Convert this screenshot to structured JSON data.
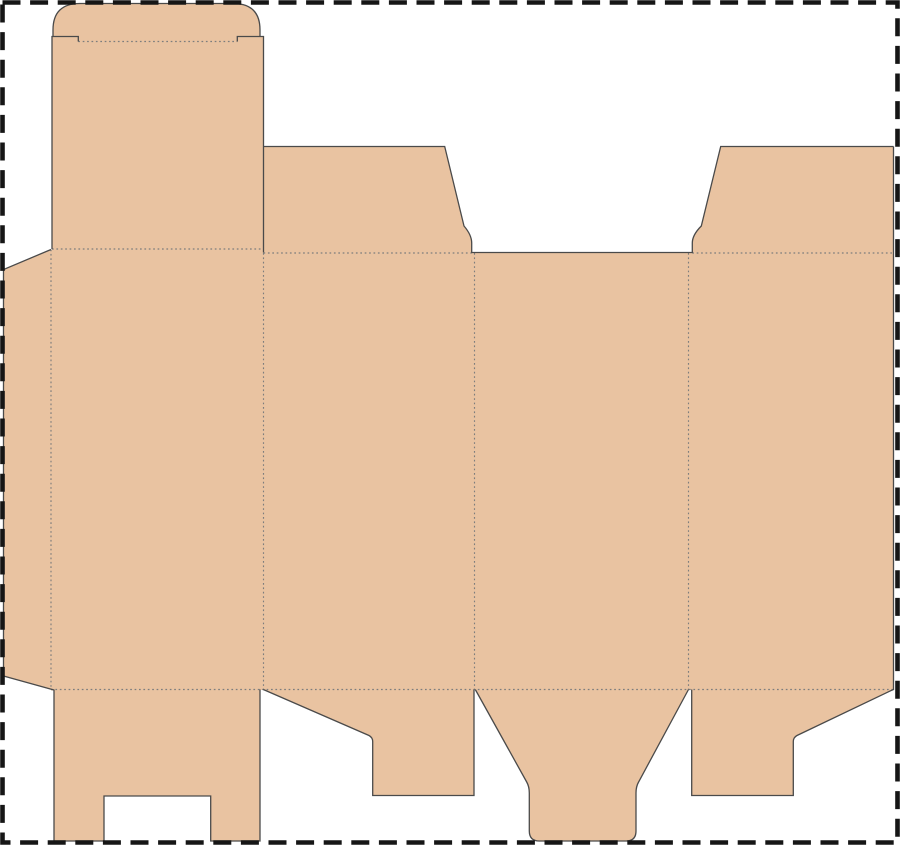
{
  "app": {
    "type": "packaging-dieline-diagram",
    "title": ""
  },
  "canvas": {
    "width": 900,
    "height": 845,
    "background": "#ffffff",
    "border": {
      "color": "#161616",
      "width": 4.6,
      "dash": "18 9.6",
      "inset": 2.5
    }
  },
  "dieline": {
    "material_color": "#e9c3a1",
    "cut_color": "#4a4a4a",
    "cut_width": 1.3,
    "fold_color": "#7d7d7d",
    "fold_width": 1.15,
    "fold_dash": "1.7 2.7",
    "fills": [
      {
        "name": "tuck-flap-fill",
        "path": "M 53,38 L 53,30 Q 53,3.5 80,3.5 L 233,3.5 Q 260,3.5 260,30 L 260,38 Z"
      },
      {
        "name": "lid-panel-fill",
        "path": "M 52,36.5 L 263.5,36.5 L 263.5,253 L 52,253 Z"
      },
      {
        "name": "glue-flap-fill",
        "path": "M 51,249.5 L 3.5,269.5 L 3.5,676 L 54,690.5 L 51,690.5 Z"
      },
      {
        "name": "body-panels-fill",
        "path": "M 51,249.5 L 263.5,249.5 L 263.5,253 L 893.5,253 L 893.5,690 L 51,690 Z"
      },
      {
        "name": "top-flap-2-fill",
        "path": "M 263.5,253 L 263.5,146.5 L 444.7,146.5 L 464,226 Q 471.7,235 471.7,243 L 471.7,253 Z"
      },
      {
        "name": "top-flap-4-fill",
        "path": "M 893.5,253 L 893.5,146.5 L 720.7,146.5 L 701.3,226 Q 692.3,235 692.3,243 L 692.3,253 Z"
      },
      {
        "name": "bottom-flap-1-fill",
        "path": "M 54,689.5 L 54,841 L 104,841 L 104,796 L 210.7,796 L 210.7,841 L 260,841 L 260,689.5 Z"
      },
      {
        "name": "bottom-flap-2-fill",
        "path": "M 263.3,689.5 L 369,735.5 Q 372.7,737.5 372.7,741.5 L 372.7,795.5 L 474,795.5 L 474,689.5 Z"
      },
      {
        "name": "bottom-flap-3-fill",
        "path": "M 475.3,689.5 L 526.7,782 Q 529.3,786.5 529.3,793 L 529.3,831 Q 529.3,841 539.3,841 L 626,841 Q 636,841 636,831 L 636,793 Q 636,786.5 638.6,782 L 688.5,689.5 Z"
      },
      {
        "name": "bottom-flap-4-fill",
        "path": "M 691.7,689.5 L 691.7,795.5 L 793.3,795.5 L 793.3,741.5 Q 793.3,737.5 797,735.5 L 890.5,690.8 L 893.5,689.5 Z"
      }
    ],
    "cuts": [
      {
        "name": "tuck-flap-outline",
        "path": "M 53,37 L 53,30 Q 53,3.5 80,3.5 L 233,3.5 Q 260,3.5 260,30 L 260,37"
      },
      {
        "name": "lid-left-edge-and-slit",
        "path": "M 52,249 L 52,36.5 L 78.3,36.5 L 78.3,41.5"
      },
      {
        "name": "lid-right-edge-and-slit",
        "path": "M 263.5,252.5 L 263.5,36.5 L 237.3,36.5 L 237.3,41.5"
      },
      {
        "name": "glue-flap-outline",
        "path": "M 51,249.5 L 3.5,269.5 L 3.5,676 L 54,690"
      },
      {
        "name": "top-flaps-and-panel3-top-edge",
        "path": "M 263.5,146.5 L 444.7,146.5 L 464,226 Q 471.7,235 471.7,243 L 471.7,252.5 L 692.3,252.5 L 692.3,243 Q 692.3,235 701.3,226 L 720.7,146.5 L 893.5,146.5"
      },
      {
        "name": "right-edge",
        "path": "M 893.5,146.5 L 893.5,690"
      },
      {
        "name": "bottom-flap-1-outline",
        "path": "M 54,689.5 L 54,841 L 104,841 L 104,796 L 210.7,796 L 210.7,841 L 260,841 L 260,689.5"
      },
      {
        "name": "bottom-flap-2-outline",
        "path": "M 263.3,689.5 L 369,735.5 Q 372.7,737.5 372.7,741.5 L 372.7,795.5 L 474,795.5 L 474,689.5"
      },
      {
        "name": "bottom-flap-3-outline",
        "path": "M 475.3,689.5 L 526.7,782 Q 529.3,786.5 529.3,793 L 529.3,831 Q 529.3,841 539.3,841 L 626,841 Q 636,841 636,831 L 636,793 Q 636,786.5 638.6,782 L 688.5,689.5"
      },
      {
        "name": "bottom-flap-4-outline",
        "path": "M 691.7,689.5 L 691.7,795.5 L 793.3,795.5 L 793.3,741.5 Q 793.3,737.5 797,735.5 L 890.5,690.8 L 893.5,689.5"
      }
    ],
    "folds": [
      {
        "name": "tuck-fold",
        "path": "M 78.3,41.5 L 237.3,41.5"
      },
      {
        "name": "lid-fold",
        "path": "M 52,249 L 263.5,249"
      },
      {
        "name": "top-flap-2-fold",
        "path": "M 263.5,253 L 471.7,253"
      },
      {
        "name": "top-flap-4-fold",
        "path": "M 692.3,253 L 893.5,253"
      },
      {
        "name": "bottom-fold",
        "path": "M 51,689.5 L 893.5,689.5"
      },
      {
        "name": "glue-flap-fold",
        "path": "M 51,249.5 L 51,689.5"
      },
      {
        "name": "panel-fold-1-2",
        "path": "M 263.5,253 L 263.5,689.5"
      },
      {
        "name": "panel-fold-2-3",
        "path": "M 474.5,253 L 474.5,689.5"
      },
      {
        "name": "panel-fold-3-4",
        "path": "M 688.5,253 L 688.5,689.5"
      }
    ]
  }
}
